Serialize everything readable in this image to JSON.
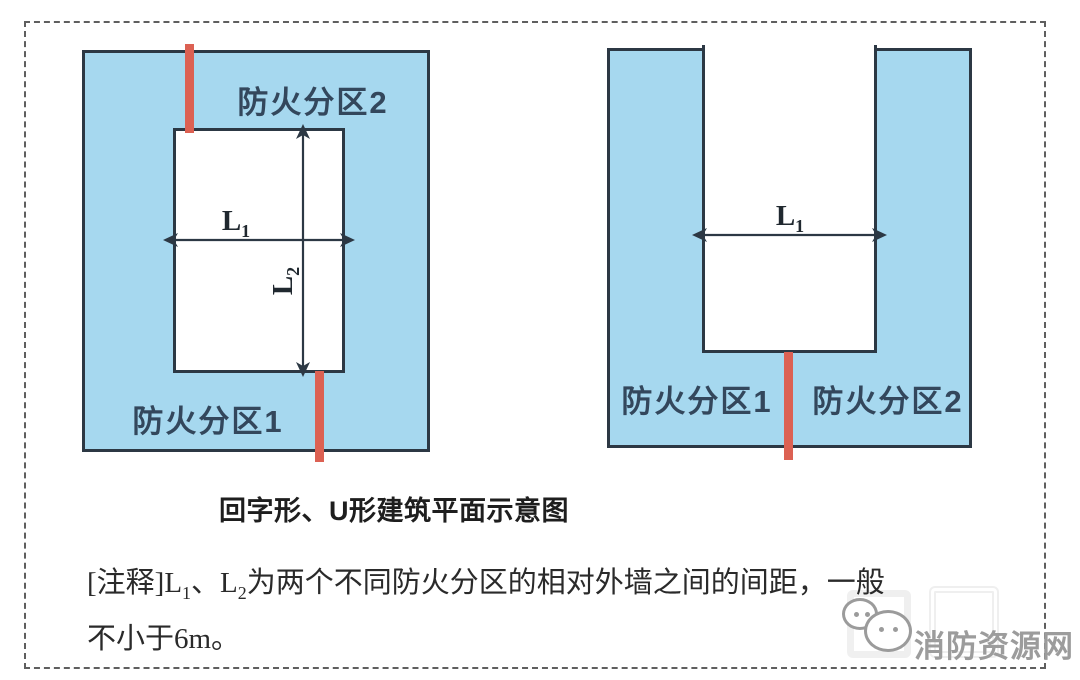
{
  "colors": {
    "zone_fill": "#a6d8ef",
    "wall_line": "#2c3844",
    "fire_separation_line": "#dc6153",
    "zone_label_text": "#33475c",
    "body_text": "#2a2a2a",
    "watermark_text": "#9c9c9c"
  },
  "diagram_left": {
    "shape": "回字形 (courtyard / donut plan)",
    "label_top": "防火分区2",
    "label_bottom": "防火分区1",
    "dim_l1": {
      "base": "L",
      "sub": "1"
    },
    "dim_l2": {
      "base": "L",
      "sub": "2"
    }
  },
  "diagram_right": {
    "shape": "U形 (U-shaped plan)",
    "label_left": "防火分区1",
    "label_right": "防火分区2",
    "dim_l1": {
      "base": "L",
      "sub": "1"
    }
  },
  "caption": "回字形、U形建筑平面示意图",
  "note": {
    "seg1": "[注释]L",
    "sub1": "1",
    "seg2": "、L",
    "sub2": "2",
    "seg3": "为两个不同防火分区的相对外墙之间的间距，一般",
    "line2": "不小于6m。"
  },
  "watermark": {
    "site_name": "消防资源网",
    "icon": "wechat-chat-bubbles-icon"
  }
}
